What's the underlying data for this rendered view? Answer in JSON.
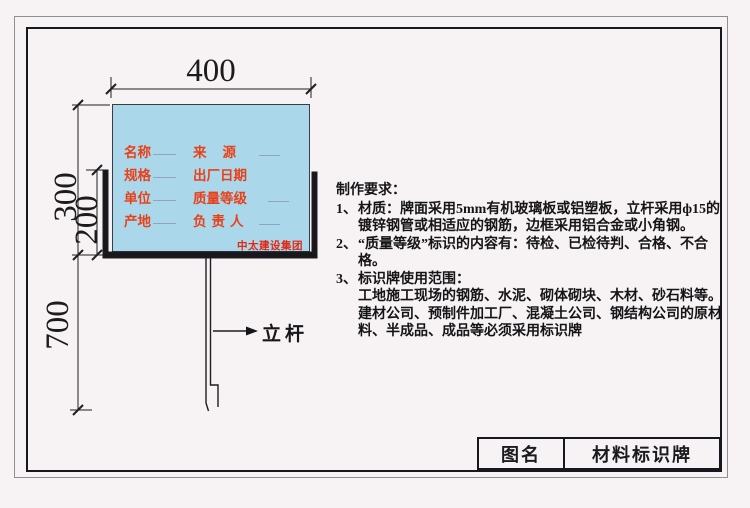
{
  "board": {
    "rows": [
      {
        "left": "名称",
        "right": "来源"
      },
      {
        "left": "规格",
        "right": "出厂日期"
      },
      {
        "left": "单位",
        "right": "质量等级"
      },
      {
        "left": "产地",
        "right": "负责人"
      }
    ],
    "company": "中太建设集团",
    "panel_color": "#abd7ea",
    "label_color": "#e8411a"
  },
  "dimensions": {
    "width": "400",
    "board_height": "300",
    "frame_height": "200",
    "pole_depth": "700"
  },
  "pole": {
    "label": "立杆"
  },
  "notes": {
    "heading": "制作要求：",
    "items": [
      {
        "num": "1、",
        "text": "材质：牌面采用5mm有机玻璃板或铝塑板，立杆采用ф15的镀锌钢管或相适应的钢筋，边框采用铝合金或小角钢。"
      },
      {
        "num": "2、",
        "text": "“质量等级”标识的内容有：待检、已检待判、合格、不合格。"
      },
      {
        "num": "3、",
        "text": "标识牌使用范围：\n工地施工现场的钢筋、水泥、砌体砌块、木材、砂石料等。建材公司、预制件加工厂、混凝土公司、钢结构公司的原材料、半成品、成品等必须采用标识牌"
      }
    ]
  },
  "title_block": {
    "label": "图名",
    "value": "材料标识牌"
  }
}
